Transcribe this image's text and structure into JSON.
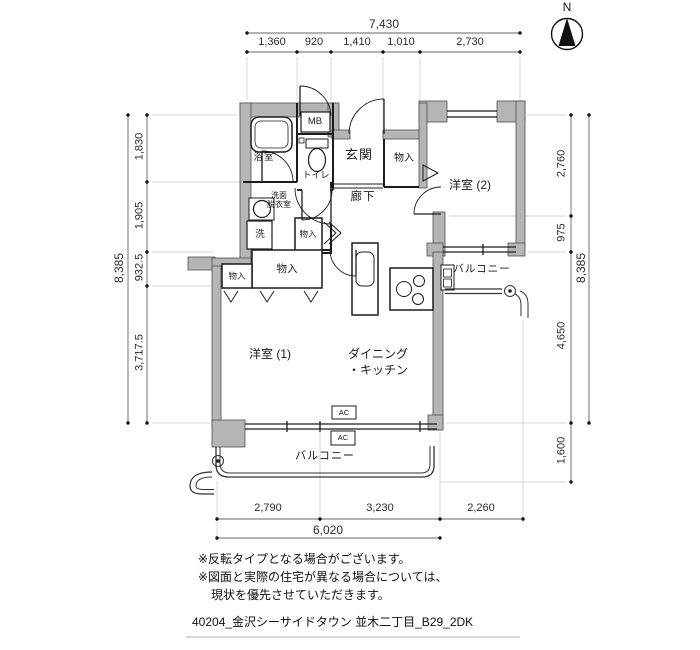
{
  "colors": {
    "wall_fill": "#b5b5b5",
    "line": "#1c1c1c",
    "dim_line": "#666666",
    "background": "#ffffff"
  },
  "compass": {
    "label": "N"
  },
  "dimensions": {
    "top": {
      "overall": "7,430",
      "segments": [
        "1,360",
        "920",
        "1,410",
        "1,010",
        "2,730"
      ]
    },
    "left": {
      "overall": "8,385",
      "segments": [
        "1,830",
        "1,905",
        "932.5",
        "3,717.5"
      ]
    },
    "right": {
      "overall": "8,385",
      "segments": [
        "2,760",
        "975",
        "4,650",
        "1,600"
      ]
    },
    "bottom": {
      "overall": "6,020",
      "segments": [
        "2,790",
        "3,230",
        "2,260"
      ]
    }
  },
  "rooms": {
    "bathroom": "浴室",
    "meter_box": "MB",
    "toilet": "トイレ",
    "entrance": "玄関",
    "closet": "物入",
    "western_room_2": "洋室 (2)",
    "corridor": "廊下",
    "washroom_line1": "洗面",
    "washroom_line2": "脱衣室",
    "laundry": "洗",
    "western_room_1": "洋室 (1)",
    "dining_kitchen_line1": "ダイニング",
    "dining_kitchen_line2": "・キッチン",
    "balcony": "バルコニー",
    "ac_unit": "AC"
  },
  "notes": {
    "line1": "※反転タイプとなる場合がございます。",
    "line2": "※図面と実際の住宅が異なる場合については、",
    "line3": "現状を優先させていただきます。"
  },
  "title": "40204_金沢シーサイドタウン 並木二丁目_B29_2DK"
}
